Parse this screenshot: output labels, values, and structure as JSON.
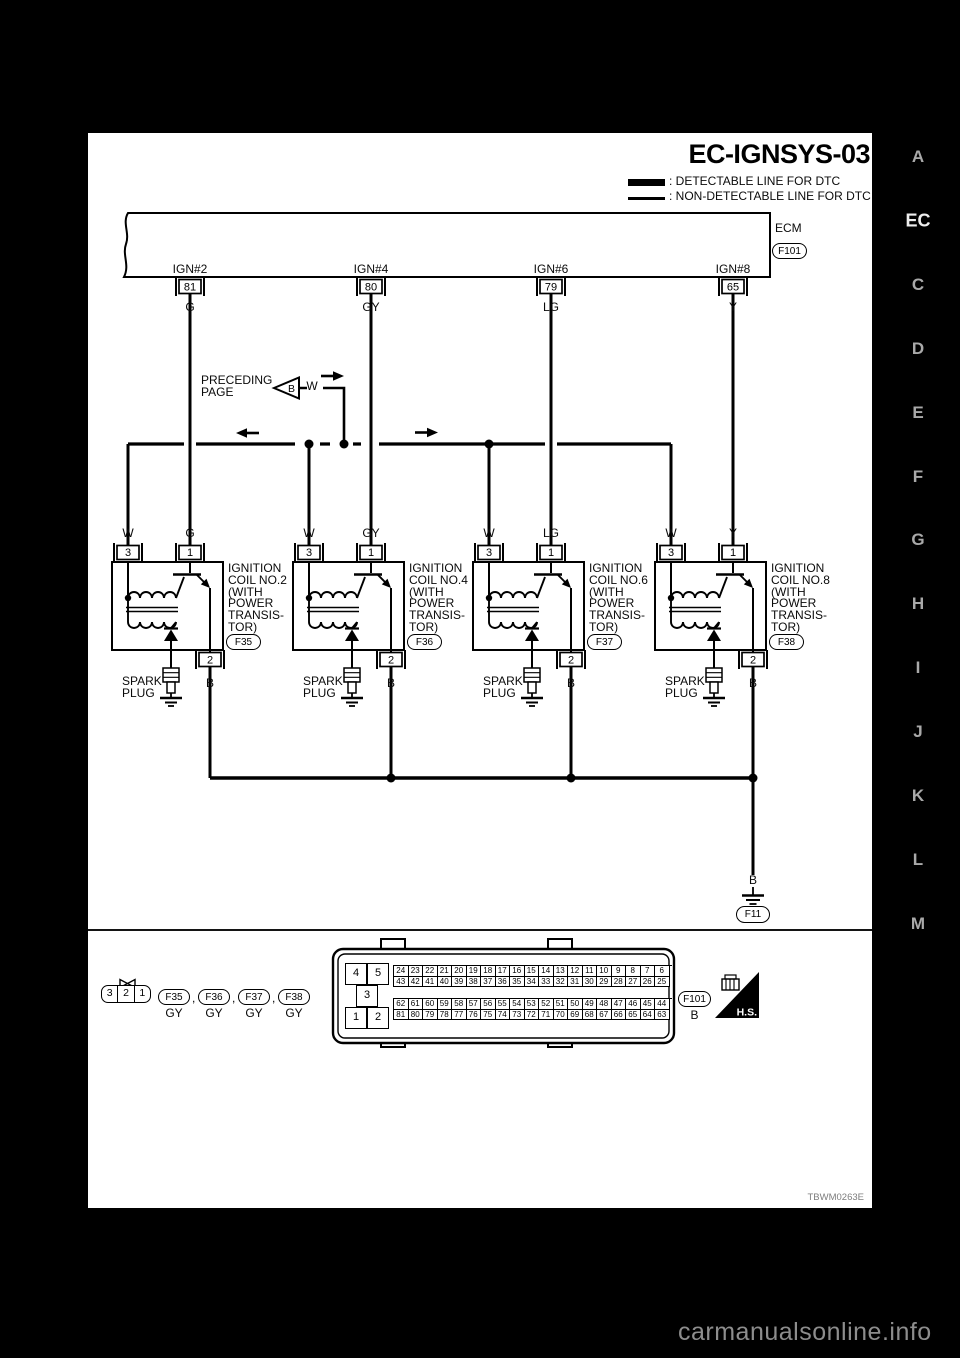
{
  "title": "EC-IGNSYS-03",
  "legend": {
    "detectable": ": DETECTABLE LINE FOR DTC",
    "non_detectable": ": NON-DETECTABLE LINE FOR DTC"
  },
  "ecm": {
    "label": "ECM",
    "connector": "F101"
  },
  "outputs": [
    {
      "name": "IGN#2",
      "terminal": "81",
      "wire": "G"
    },
    {
      "name": "IGN#4",
      "terminal": "80",
      "wire": "GY"
    },
    {
      "name": "IGN#6",
      "terminal": "79",
      "wire": "LG"
    },
    {
      "name": "IGN#8",
      "terminal": "65",
      "wire": "Y"
    }
  ],
  "preceding_page": {
    "label": "PRECEDING\nPAGE",
    "marker": "B",
    "wire": "W"
  },
  "coils": [
    {
      "name": "IGNITION\nCOIL NO.2\n(WITH\n POWER\n TRANSIS-\nTOR)",
      "connector": "F35",
      "wire_left": "W",
      "wire_right": "G",
      "t_left": "3",
      "t_right": "1",
      "t_bottom": "2",
      "spark_plug": "SPARK\nPLUG",
      "ground_wire": "B"
    },
    {
      "name": "IGNITION\nCOIL NO.4\n(WITH\n POWER\n TRANSIS-\nTOR)",
      "connector": "F36",
      "wire_left": "W",
      "wire_right": "GY",
      "t_left": "3",
      "t_right": "1",
      "t_bottom": "2",
      "spark_plug": "SPARK\nPLUG",
      "ground_wire": "B"
    },
    {
      "name": "IGNITION\nCOIL NO.6\n(WITH\n POWER\n TRANSIS-\nTOR)",
      "connector": "F37",
      "wire_left": "W",
      "wire_right": "LG",
      "t_left": "3",
      "t_right": "1",
      "t_bottom": "2",
      "spark_plug": "SPARK\nPLUG",
      "ground_wire": "B"
    },
    {
      "name": "IGNITION\nCOIL NO.8\n(WITH\n POWER\n TRANSIS-\nTOR)",
      "connector": "F38",
      "wire_left": "W",
      "wire_right": "Y",
      "t_left": "3",
      "t_right": "1",
      "t_bottom": "2",
      "spark_plug": "SPARK\nPLUG",
      "ground_wire": "B"
    }
  ],
  "ground": {
    "wire": "B",
    "connector": "F11"
  },
  "footer": {
    "coil_connector": {
      "pins": [
        "3",
        "2",
        "1"
      ],
      "refs": [
        {
          "id": "F35",
          "color": "GY"
        },
        {
          "id": "F36",
          "color": "GY"
        },
        {
          "id": "F37",
          "color": "GY"
        },
        {
          "id": "F38",
          "color": "GY"
        }
      ],
      "separator": ","
    },
    "ecm_connector": {
      "side_pins": [
        "4",
        "5",
        "3",
        "1",
        "2"
      ],
      "grid_top": [
        [
          "24",
          "23",
          "22",
          "21",
          "20",
          "19",
          "18",
          "17",
          "16",
          "15",
          "14",
          "13",
          "12",
          "11",
          "10",
          "9",
          "8",
          "7",
          "6"
        ],
        [
          "43",
          "42",
          "41",
          "40",
          "39",
          "38",
          "37",
          "36",
          "35",
          "34",
          "33",
          "32",
          "31",
          "30",
          "29",
          "28",
          "27",
          "26",
          "25"
        ]
      ],
      "grid_bottom": [
        [
          "62",
          "61",
          "60",
          "59",
          "58",
          "57",
          "56",
          "55",
          "54",
          "53",
          "52",
          "51",
          "50",
          "49",
          "48",
          "47",
          "46",
          "45",
          "44"
        ],
        [
          "81",
          "80",
          "79",
          "78",
          "77",
          "76",
          "75",
          "74",
          "73",
          "72",
          "71",
          "70",
          "69",
          "68",
          "67",
          "66",
          "65",
          "64",
          "63"
        ]
      ],
      "id": "F101",
      "wire": "B",
      "hs_label": "H.S."
    },
    "figure_code": "TBWM0263E"
  },
  "sidebar": {
    "letters": [
      {
        "label": "A"
      },
      {
        "label": "EC",
        "active": true
      },
      {
        "label": "C"
      },
      {
        "label": "D"
      },
      {
        "label": "E"
      },
      {
        "label": "F"
      },
      {
        "label": "G"
      },
      {
        "label": "H"
      },
      {
        "label": "I"
      },
      {
        "label": "J"
      },
      {
        "label": "K"
      },
      {
        "label": "L"
      },
      {
        "label": "M"
      }
    ]
  },
  "watermark": "carmanualsonline.info"
}
